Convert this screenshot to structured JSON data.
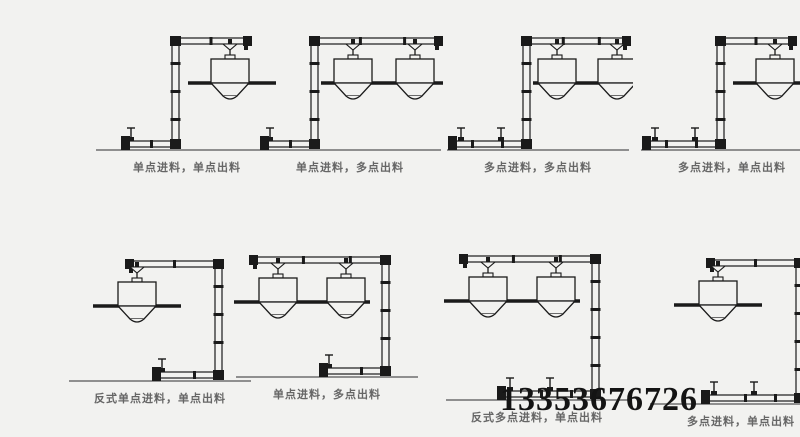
{
  "colors": {
    "background": "#f2f2f0",
    "line": "#1a1a1a",
    "ground": "#8f8f8f",
    "label": "#666666",
    "phone": "#141414"
  },
  "phone_number": "13353676726",
  "diagrams": [
    {
      "label": "单点进料，单点出料",
      "type": "z",
      "feeds": 1,
      "hoppers": 1
    },
    {
      "label": "单点进料，多点出料",
      "type": "z",
      "feeds": 1,
      "hoppers": 2
    },
    {
      "label": "多点进料，多点出料",
      "type": "z",
      "feeds": 2,
      "hoppers": 2
    },
    {
      "label": "多点进料，单点出料",
      "type": "z",
      "feeds": 2,
      "hoppers": 1
    },
    {
      "label": "反式单点进料，单点出料",
      "type": "reverse",
      "feeds": 1,
      "hoppers": 1
    },
    {
      "label": "单点进料，多点出料",
      "type": "reverse",
      "feeds": 1,
      "hoppers": 2
    },
    {
      "label": "反式多点进料，单点出料",
      "type": "reverse",
      "feeds": 2,
      "hoppers": 2
    },
    {
      "label": "多点进料，单点出料",
      "type": "reverse",
      "feeds": 2,
      "hoppers": 1
    }
  ]
}
